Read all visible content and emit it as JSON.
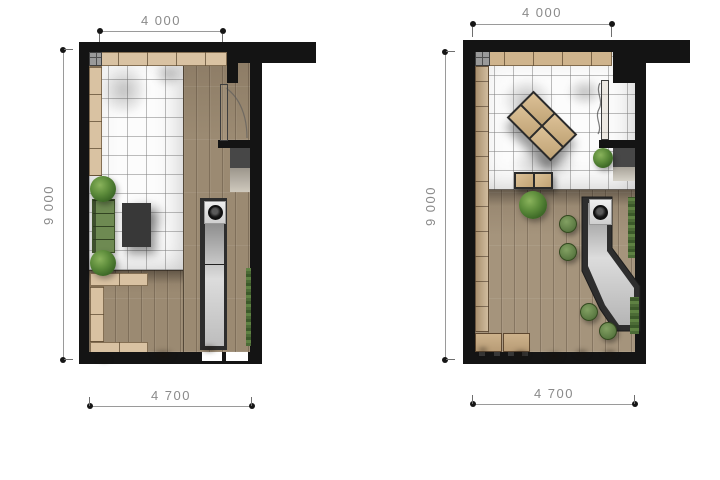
{
  "theme": {
    "wall": "#141414",
    "wood": "#9b8a72",
    "woodDeck": "#a5947c",
    "counter": "#d9c2a2",
    "sofa": "#6e8a52",
    "furnitureDark": "#383838",
    "plantGreen": "#4c7a33",
    "stoolGreen": "#5d7b44",
    "greenWall": "#4c6b36",
    "tileLine": "#7d7d7d",
    "dimLine": "#9a9a9a",
    "dimText": "#8a8a8a",
    "background": "#ffffff"
  },
  "plans": {
    "left": {
      "dims": {
        "width_top": "4 000",
        "height_left": "9 000",
        "width_bottom": "4 700"
      }
    },
    "right": {
      "dims": {
        "width_top": "4 000",
        "height_left": "9 000",
        "width_bottom": "4 700"
      }
    }
  }
}
